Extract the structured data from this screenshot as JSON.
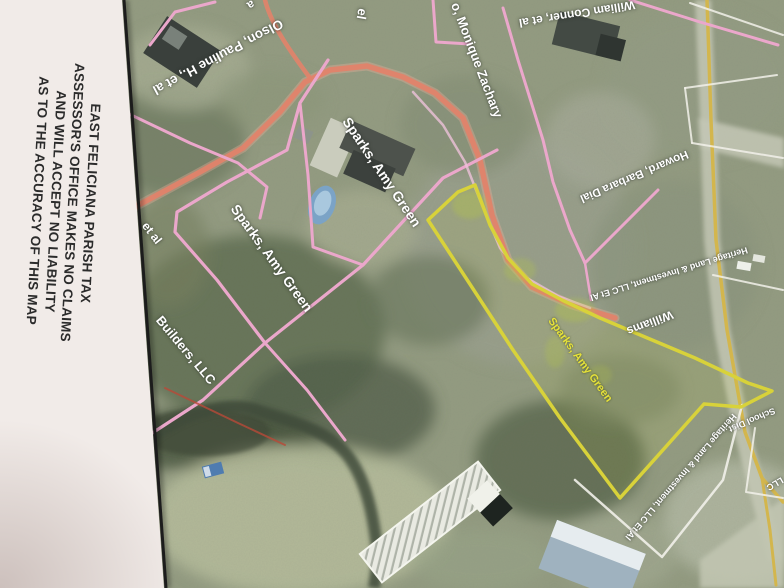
{
  "photo_title": "East Feliciana Parish tax assessor parcel map photo",
  "disclaimer": {
    "lines": [
      "EAST FELICIANA PARISH TAX",
      "ASSESSOR'S OFFICE MAKES NO CLAIMS",
      "AND WILL ACCEPT NO LIABILITY",
      "AS TO THE ACCURACY OF THIS MAP"
    ]
  },
  "map_labels": [
    {
      "text": "Olson, Pauline H., et al",
      "color": "white"
    },
    {
      "text": "William Conner, et al",
      "color": "white"
    },
    {
      "text": "o, Monique Zachary",
      "color": "white"
    },
    {
      "text": "Howard, Barbara Dial",
      "color": "white"
    },
    {
      "text": "Heritage Land & Investment, LLC Et Al",
      "color": "white"
    },
    {
      "text": "Williams",
      "color": "white"
    },
    {
      "text": "Sparks, Amy Green",
      "color": "white"
    },
    {
      "text": "Sparks, Amy Green",
      "color": "white"
    },
    {
      "text": "Sparks, Amy Green",
      "color": "yellow"
    },
    {
      "text": "Builders, LLC",
      "color": "white"
    },
    {
      "text": "et al",
      "color": "white"
    },
    {
      "text": "Heritage Land & Investment, LLC Et Al",
      "color": "white"
    },
    {
      "text": "School Dist",
      "color": "white"
    },
    {
      "text": "LLC",
      "color": "white"
    },
    {
      "text": "el",
      "color": "white"
    },
    {
      "text": "a",
      "color": "white"
    }
  ],
  "palette": {
    "pink": "#eba7cb",
    "pink_light": "#eec2da",
    "salmon": "#e2836a",
    "salmon_glow": "#f0b09c",
    "gold": "#d3b64d",
    "white_line": "#f2f1ea",
    "red_line": "#b84a38",
    "yellow_parcel": "#d8d23a",
    "label_yellow": "#e6e23a",
    "border_black": "#1c1c1c",
    "paper": "#f1ebe8"
  }
}
